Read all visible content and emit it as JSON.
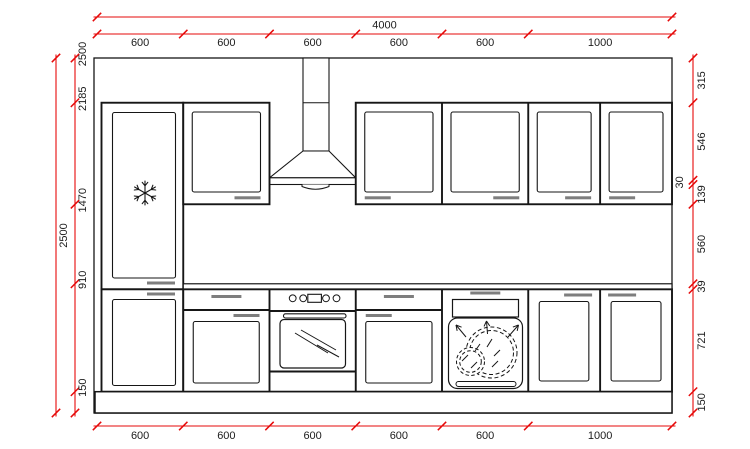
{
  "palette": {
    "dimension_color": "#e60a0a",
    "line_color": "#161616",
    "handle_color": "#7e7e7e",
    "background": "#ffffff"
  },
  "drawing": {
    "width_mm": 4000,
    "height_mm": 2500,
    "top_total": {
      "mm": 4000,
      "label": "4000"
    },
    "left_total": {
      "mm": 2500,
      "label": "2500"
    },
    "top_segments": [
      {
        "mm": 600,
        "label": "600"
      },
      {
        "mm": 600,
        "label": "600"
      },
      {
        "mm": 600,
        "label": "600"
      },
      {
        "mm": 600,
        "label": "600"
      },
      {
        "mm": 600,
        "label": "600"
      },
      {
        "mm": 1000,
        "label": "1000"
      }
    ],
    "bottom_segments": [
      {
        "mm": 600,
        "label": "600"
      },
      {
        "mm": 600,
        "label": "600"
      },
      {
        "mm": 600,
        "label": "600"
      },
      {
        "mm": 600,
        "label": "600"
      },
      {
        "mm": 600,
        "label": "600"
      },
      {
        "mm": 1000,
        "label": "1000"
      }
    ],
    "left_marks": [
      {
        "mm": 2500,
        "label": "2500"
      },
      {
        "mm": 2185,
        "label": "2185"
      },
      {
        "mm": 1470,
        "label": "1470"
      },
      {
        "mm": 910,
        "label": "910"
      },
      {
        "mm": 150,
        "label": "150"
      }
    ],
    "right_segments": [
      {
        "mm": 315,
        "label": "315",
        "side": "right"
      },
      {
        "mm": 546,
        "label": "546",
        "side": "right"
      },
      {
        "mm": 30,
        "label": "30",
        "side": "left"
      },
      {
        "mm": 139,
        "label": "139",
        "side": "right"
      },
      {
        "mm": 560,
        "label": "560",
        "side": "right"
      },
      {
        "mm": 39,
        "label": "39",
        "side": "right"
      },
      {
        "mm": 721,
        "label": "721",
        "side": "right"
      },
      {
        "mm": 150,
        "label": "150",
        "side": "right"
      }
    ]
  },
  "fixtures": {
    "fridge": "snowflake-icon",
    "extractor_hood": "hood-chimney-icon",
    "oven": "oven-controls-and-glass-door",
    "dishwasher": "dishes-icon"
  }
}
